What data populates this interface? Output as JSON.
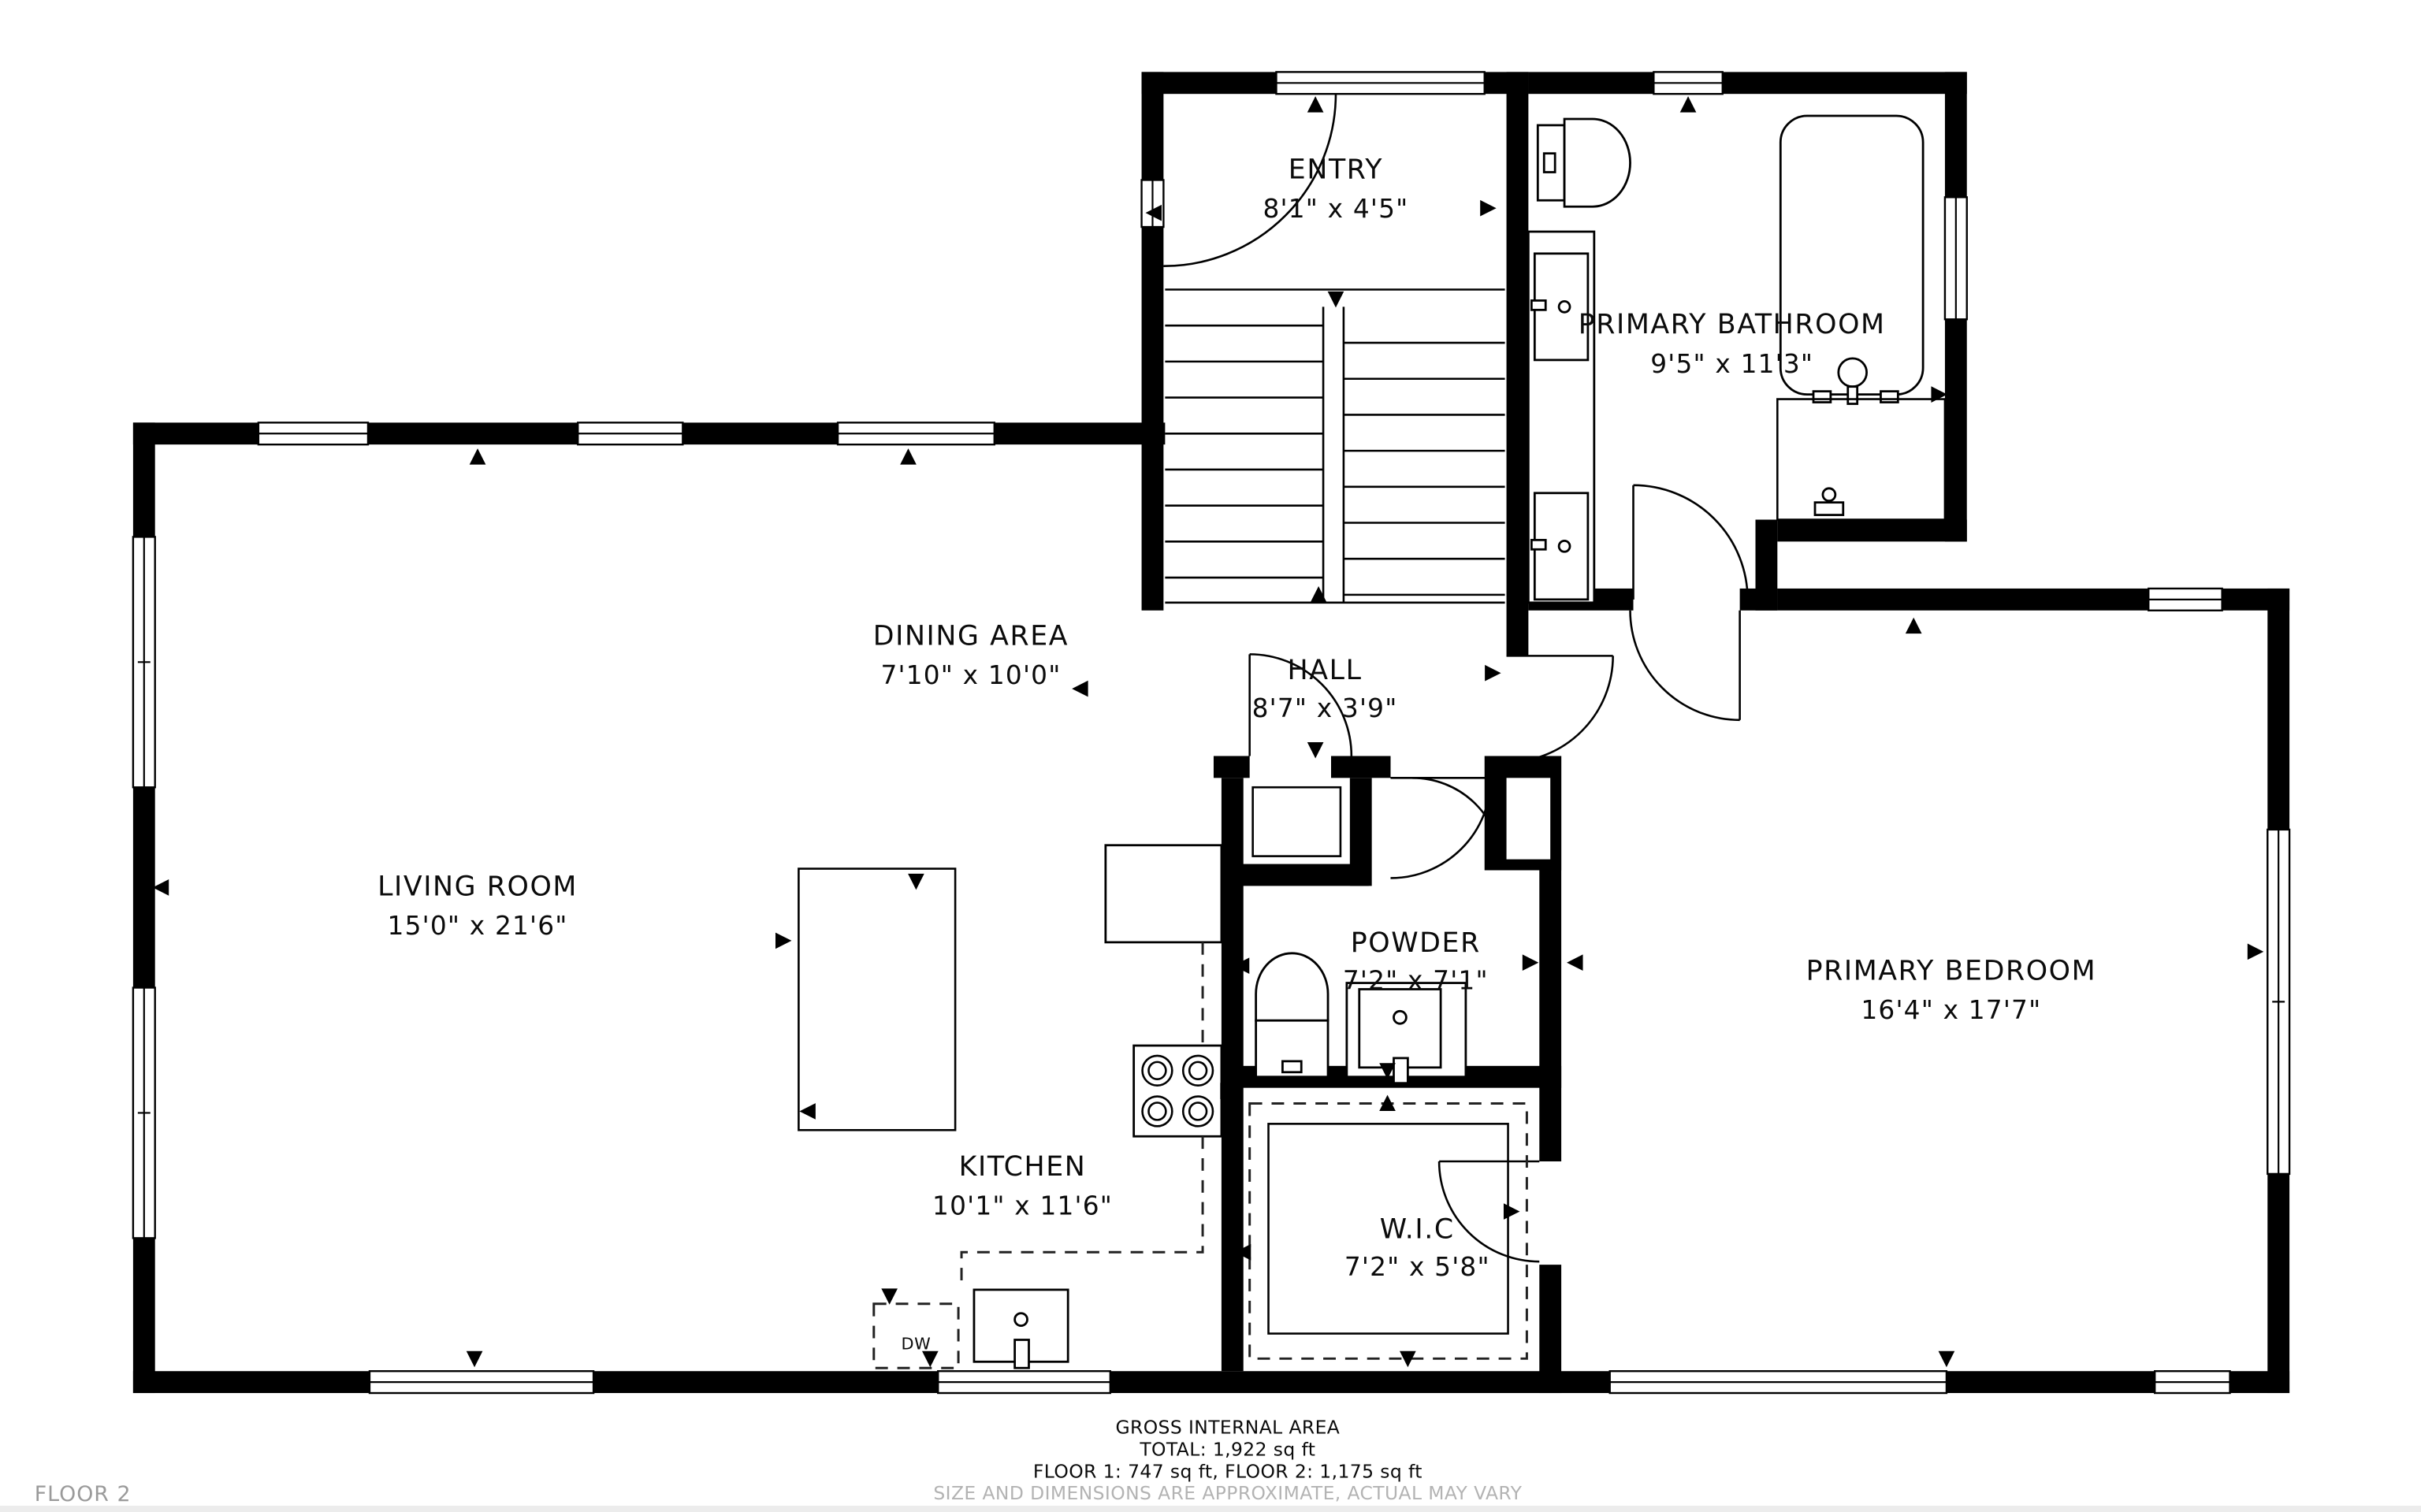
{
  "floor_label": "FLOOR 2",
  "rooms": {
    "entry": {
      "name": "ENTRY",
      "dims": "8'1\" x 4'5\""
    },
    "primary_bathroom": {
      "name": "PRIMARY BATHROOM",
      "dims": "9'5\" x 11'3\""
    },
    "dining_area": {
      "name": "DINING AREA",
      "dims": "7'10\" x 10'0\""
    },
    "hall": {
      "name": "HALL",
      "dims": "8'7\" x 3'9\""
    },
    "living_room": {
      "name": "LIVING ROOM",
      "dims": "15'0\" x 21'6\""
    },
    "powder": {
      "name": "POWDER",
      "dims": "7'2\" x 7'1\""
    },
    "primary_bedroom": {
      "name": "PRIMARY BEDROOM",
      "dims": "16'4\" x 17'7\""
    },
    "kitchen": {
      "name": "KITCHEN",
      "dims": "10'1\" x 11'6\""
    },
    "wic": {
      "name": "W.I.C",
      "dims": "7'2\" x 5'8\""
    }
  },
  "appliances": {
    "dishwasher": "DW"
  },
  "footer": {
    "line1": "GROSS INTERNAL AREA",
    "line2": "TOTAL: 1,922 sq ft",
    "line3": "FLOOR 1: 747 sq ft, FLOOR 2: 1,175 sq ft",
    "disclaimer": "SIZE AND DIMENSIONS ARE APPROXIMATE, ACTUAL MAY VARY"
  },
  "colors": {
    "walls": "#000000",
    "background": "#ffffff",
    "muted_text": "#b3b3b3"
  }
}
